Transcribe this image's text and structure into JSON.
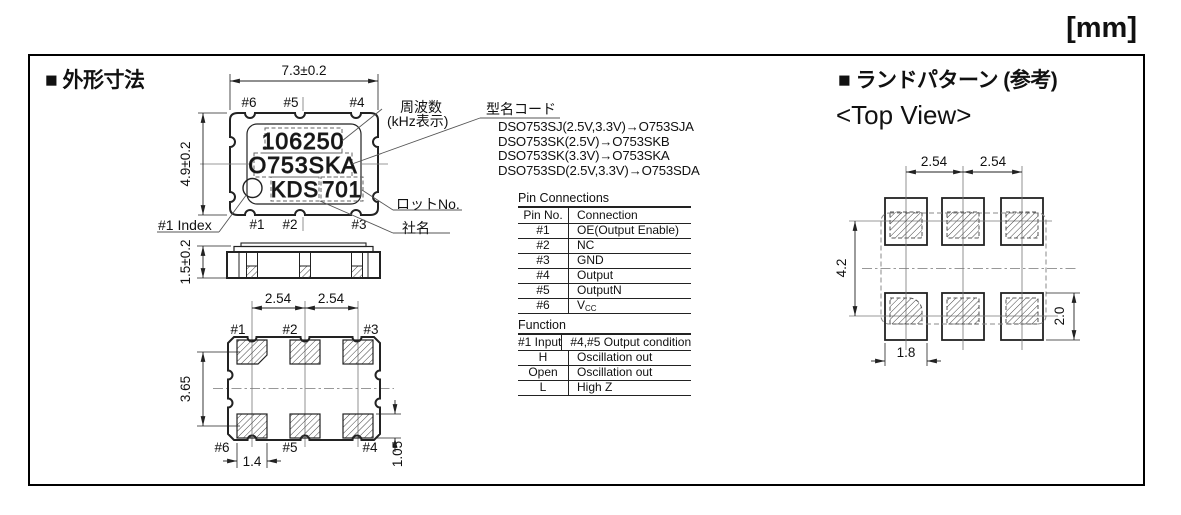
{
  "units_label": "[mm]",
  "outline": {
    "title": "■ 外形寸法",
    "top_view": {
      "width_dim": "7.3±0.2",
      "height_dim": "4.9±0.2",
      "pin_labels_top": [
        "#6",
        "#5",
        "#4"
      ],
      "pin_labels_bottom": [
        "#1",
        "#2",
        "#3"
      ],
      "marking": {
        "frequency": "106250",
        "type_code": "O753SKA",
        "company": "KDS",
        "lot": "701"
      },
      "index_label": "#1 Index",
      "frequency_label": "周波数",
      "frequency_label2": "(kHz表示)",
      "type_code_label": "型名コード",
      "lot_label": "ロットNo.",
      "company_label": "社名"
    },
    "side_view": {
      "height_dim": "1.5±0.2"
    },
    "bottom_view": {
      "pitch_dim1": "2.54",
      "pitch_dim2": "2.54",
      "pin_labels_top": [
        "#1",
        "#2",
        "#3"
      ],
      "pin_labels_bottom": [
        "#6",
        "#5",
        "#4"
      ],
      "row_pitch_dim": "3.65",
      "pad_width_dim": "1.4",
      "pad_height_dim": "1.05"
    }
  },
  "type_codes": [
    "DSO753SJ(2.5V,3.3V)→O753SJA",
    "DSO753SK(2.5V)→O753SKB",
    "DSO753SK(3.3V)→O753SKA",
    "DSO753SD(2.5V,3.3V)→O753SDA"
  ],
  "pin_connections": {
    "title": "Pin Connections",
    "headers": [
      "Pin No.",
      "Connection"
    ],
    "rows": [
      {
        "pin": "#1",
        "connection": "OE(Output Enable)"
      },
      {
        "pin": "#2",
        "connection": "NC"
      },
      {
        "pin": "#3",
        "connection": "GND"
      },
      {
        "pin": "#4",
        "connection": "Output"
      },
      {
        "pin": "#5",
        "connection": "OutputN"
      },
      {
        "pin": "#6",
        "connection": "V",
        "connection_sub": "CC"
      }
    ]
  },
  "function_table": {
    "title": "Function",
    "headers": [
      "#1 Input",
      "#4,#5 Output condition"
    ],
    "rows": [
      {
        "input": "H",
        "output": "Oscillation out"
      },
      {
        "input": "Open",
        "output": "Oscillation out"
      },
      {
        "input": "L",
        "output": "High Z"
      }
    ]
  },
  "land_pattern": {
    "title": "■ ランドパターン (参考)",
    "subtitle": "<Top View>",
    "pitch_dim1": "2.54",
    "pitch_dim2": "2.54",
    "row_pitch_dim": "4.2",
    "pad_width_dim": "1.8",
    "pad_height_dim": "2.0"
  }
}
